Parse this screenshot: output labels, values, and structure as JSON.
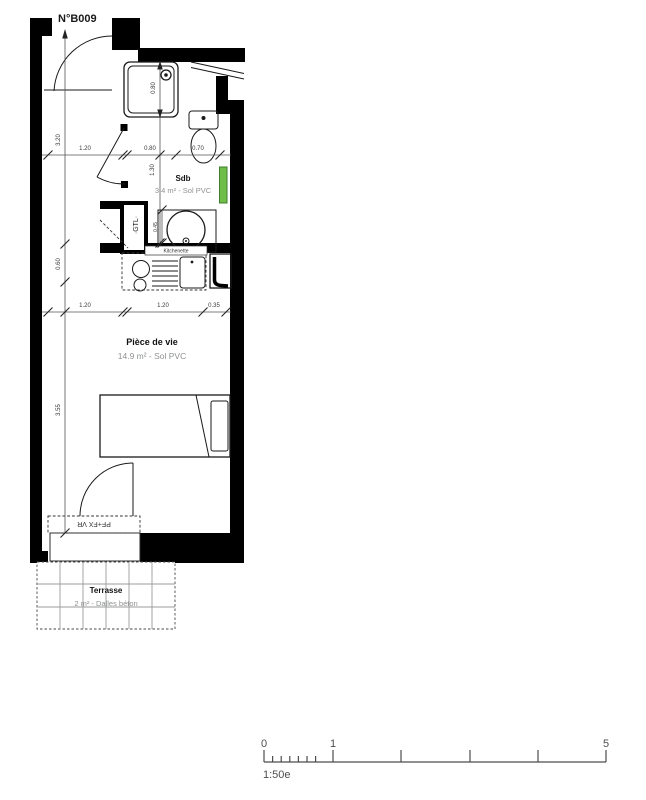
{
  "plan": {
    "unit_number": "N°B009",
    "rooms": {
      "bathroom": {
        "name": "Sdb",
        "details": "3.4 m² -  Sol PVC"
      },
      "living": {
        "name": "Pièce de vie",
        "details": "14.9 m² -  Sol PVC"
      },
      "terrace": {
        "name": "Terrasse",
        "details": "2 m² -  Dalles béton"
      }
    },
    "annotations": {
      "gtl": "·GTL·",
      "window": "PF+FX VR",
      "kitchenette": "Kitchenette"
    },
    "dims": {
      "top": [
        "1.20",
        "0.80",
        "0.70"
      ],
      "middle": [
        "1.20",
        "1.20",
        "0.35"
      ],
      "left": [
        "3.20",
        "0.60",
        "3.55"
      ],
      "shower": "0.80",
      "bath_depth": "1.30",
      "vanity": "0.45"
    },
    "colors": {
      "radiator": "#6fbe4a",
      "radiator_border": "#3e7d2c"
    }
  },
  "scale_bar": {
    "start": "0",
    "mid": "1",
    "end": "5",
    "ratio": "1:50e"
  }
}
